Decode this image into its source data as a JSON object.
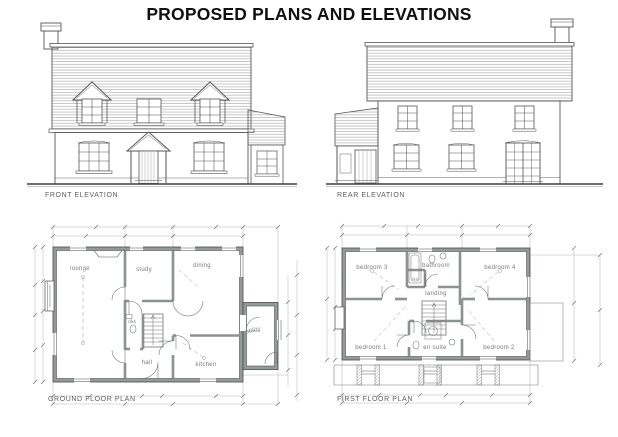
{
  "title": "PROPOSED PLANS AND ELEVATIONS",
  "front_elevation": {
    "caption": "FRONT ELEVATION"
  },
  "rear_elevation": {
    "caption": "REAR ELEVATION"
  },
  "ground_floor_plan": {
    "caption": "GROUND FLOOR PLAN",
    "rooms": {
      "lounge": "lounge",
      "study": "study",
      "dining": "dining",
      "utility": "utility",
      "kitchen": "kitchen",
      "hall": "hall",
      "cloaks": "clks"
    }
  },
  "first_floor_plan": {
    "caption": "FIRST FLOOR PLAN",
    "rooms": {
      "bedroom3": "bedroom 3",
      "bathroom": "bathroom",
      "bedroom4": "bedroom 4",
      "landing": "landing",
      "airing_cupboard": "a.c.",
      "bedroom1": "bedroom 1",
      "ensuite": "en suite",
      "bedroom2": "bedroom 2"
    }
  },
  "colors": {
    "ink": "#555555",
    "wall_fill": "#939b99",
    "roof_hatch": "#9b9b9b",
    "dimension": "#a0a0a0",
    "title_text": "#101010",
    "label_text": "#5d5d5d",
    "background": "#ffffff"
  }
}
